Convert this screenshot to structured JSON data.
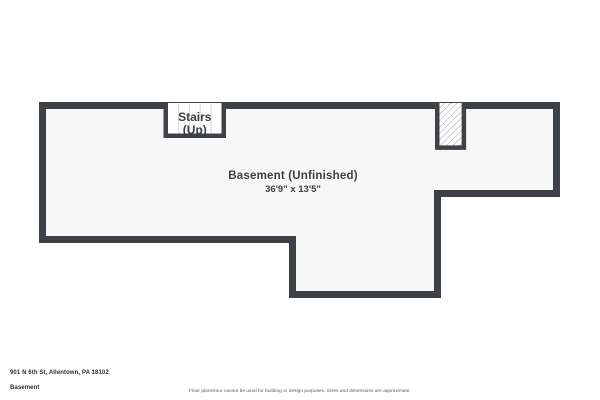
{
  "floorplan": {
    "room_label": "Basement (Unfinished)",
    "room_dimensions": "36'9\" x 13'5\"",
    "stairs_label_line1": "Stairs",
    "stairs_label_line2": "(Up)"
  },
  "footer": {
    "address": "901 N 6th St, Allentown, PA 18102",
    "floor_name": "Basement",
    "disclaimer": "Floor plans/tour cannot be used for building or design purposes. Sizes and dimensions are approximate."
  },
  "colors": {
    "wall": "#3e4246",
    "floor_fill": "#f7f7f8",
    "stair_tread_line": "#d9d9d9",
    "hatch_line": "#9b9b9b",
    "label_text": "#3b3f44"
  }
}
